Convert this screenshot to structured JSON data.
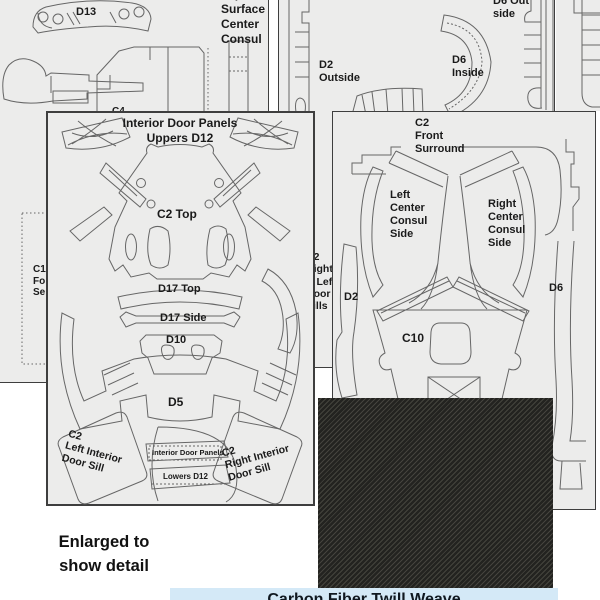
{
  "colors": {
    "page_bg": "#ffffff",
    "sheet_bg": "#ececeb",
    "sheet_border": "#3e3e3e",
    "outline": "#666666",
    "text": "#1a1a1a",
    "carbon_dark": "#232320",
    "carbon_light": "#45443e",
    "caption_bg": "#d4e9f7",
    "caption_text": "#101820"
  },
  "sheet_a": {
    "d13": "D13",
    "console_note": [
      "Top",
      "Surface",
      "Center",
      "Consul"
    ],
    "c1_note": [
      "C1",
      "Fo",
      "Se"
    ],
    "c4_note": "C4"
  },
  "sheet_b": {
    "d2_outside": [
      "D2",
      "Outside"
    ],
    "d6_inside": [
      "D6",
      "Inside"
    ],
    "d6_outside": "D6 Outside",
    "door_sills_note": [
      "C2",
      "Right",
      "& Left",
      "Door",
      "Sills"
    ]
  },
  "sheet_c": {
    "front_surround": [
      "C2",
      "Front",
      "Surround"
    ],
    "left_consul": [
      "Left",
      "Center",
      "Consul",
      "Side"
    ],
    "right_consul": [
      "Right",
      "Center",
      "Consul",
      "Side"
    ],
    "d2": "D2",
    "d6": "D6",
    "c10": "C10"
  },
  "sheet_d12": {
    "title": [
      "Interior Door Panels",
      "Uppers D12"
    ],
    "c2_top": "C2 Top",
    "d17_top": "D17 Top",
    "d17_side": "D17 Side",
    "d10": "D10",
    "d5": "D5",
    "left_sill": [
      "C2",
      "Left Interior",
      "Door Sill"
    ],
    "lowers_box": "Interior Door Panels",
    "lowers_label": "Lowers D12",
    "right_sill": [
      "C2",
      "Right Interior",
      "Door Sill"
    ]
  },
  "footer": {
    "enlarged_note": [
      "Enlarged to",
      "show detail"
    ],
    "caption": "Carbon Fiber Twill Weave"
  }
}
